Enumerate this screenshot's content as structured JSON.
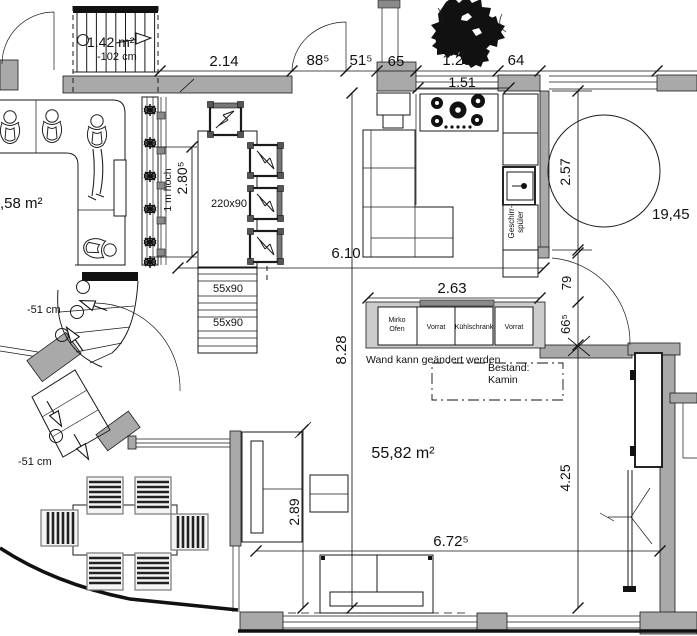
{
  "colors": {
    "wall": "#a9a9a9",
    "counter": "#cccccc",
    "ink": "#111111"
  },
  "areas": {
    "stair": "1.42 m²",
    "stair_offset": "-102 cm",
    "terrace": ",58 m²",
    "living": "55,82 m²",
    "right": "19,45"
  },
  "dims": {
    "d214": "2.14",
    "d885": "88⁵",
    "d515": "51⁵",
    "d65": "65",
    "d125": "1.25",
    "d64": "64",
    "d151": "1.51",
    "d257": "2.57",
    "d610": "6.10",
    "d263": "2.63",
    "d79": "79",
    "d665": "66⁵",
    "d828": "8.28",
    "d2805": "2.80⁵",
    "d289": "2.89",
    "d6725": "6.72⁵",
    "d425": "4.25"
  },
  "labels": {
    "railing": "1 m hoch",
    "table": "220x90",
    "sideboard_top": "55x90",
    "sideboard_bottom": "55x90",
    "step_upper": "-51 cm",
    "step_lower": "-51 cm",
    "wall_note": "Wand kann geändert werden",
    "existing_line1": "Bestand:",
    "existing_line2": "Kamin",
    "dishwasher_line1": "Geschirr-",
    "dishwasher_line2": "spüler"
  },
  "kitchen_units": {
    "unit1_line1": "Mirko",
    "unit1_line2": "Ofen",
    "unit2": "Vorrat",
    "unit3": "Kühlschrank",
    "unit4": "Vorrat"
  }
}
